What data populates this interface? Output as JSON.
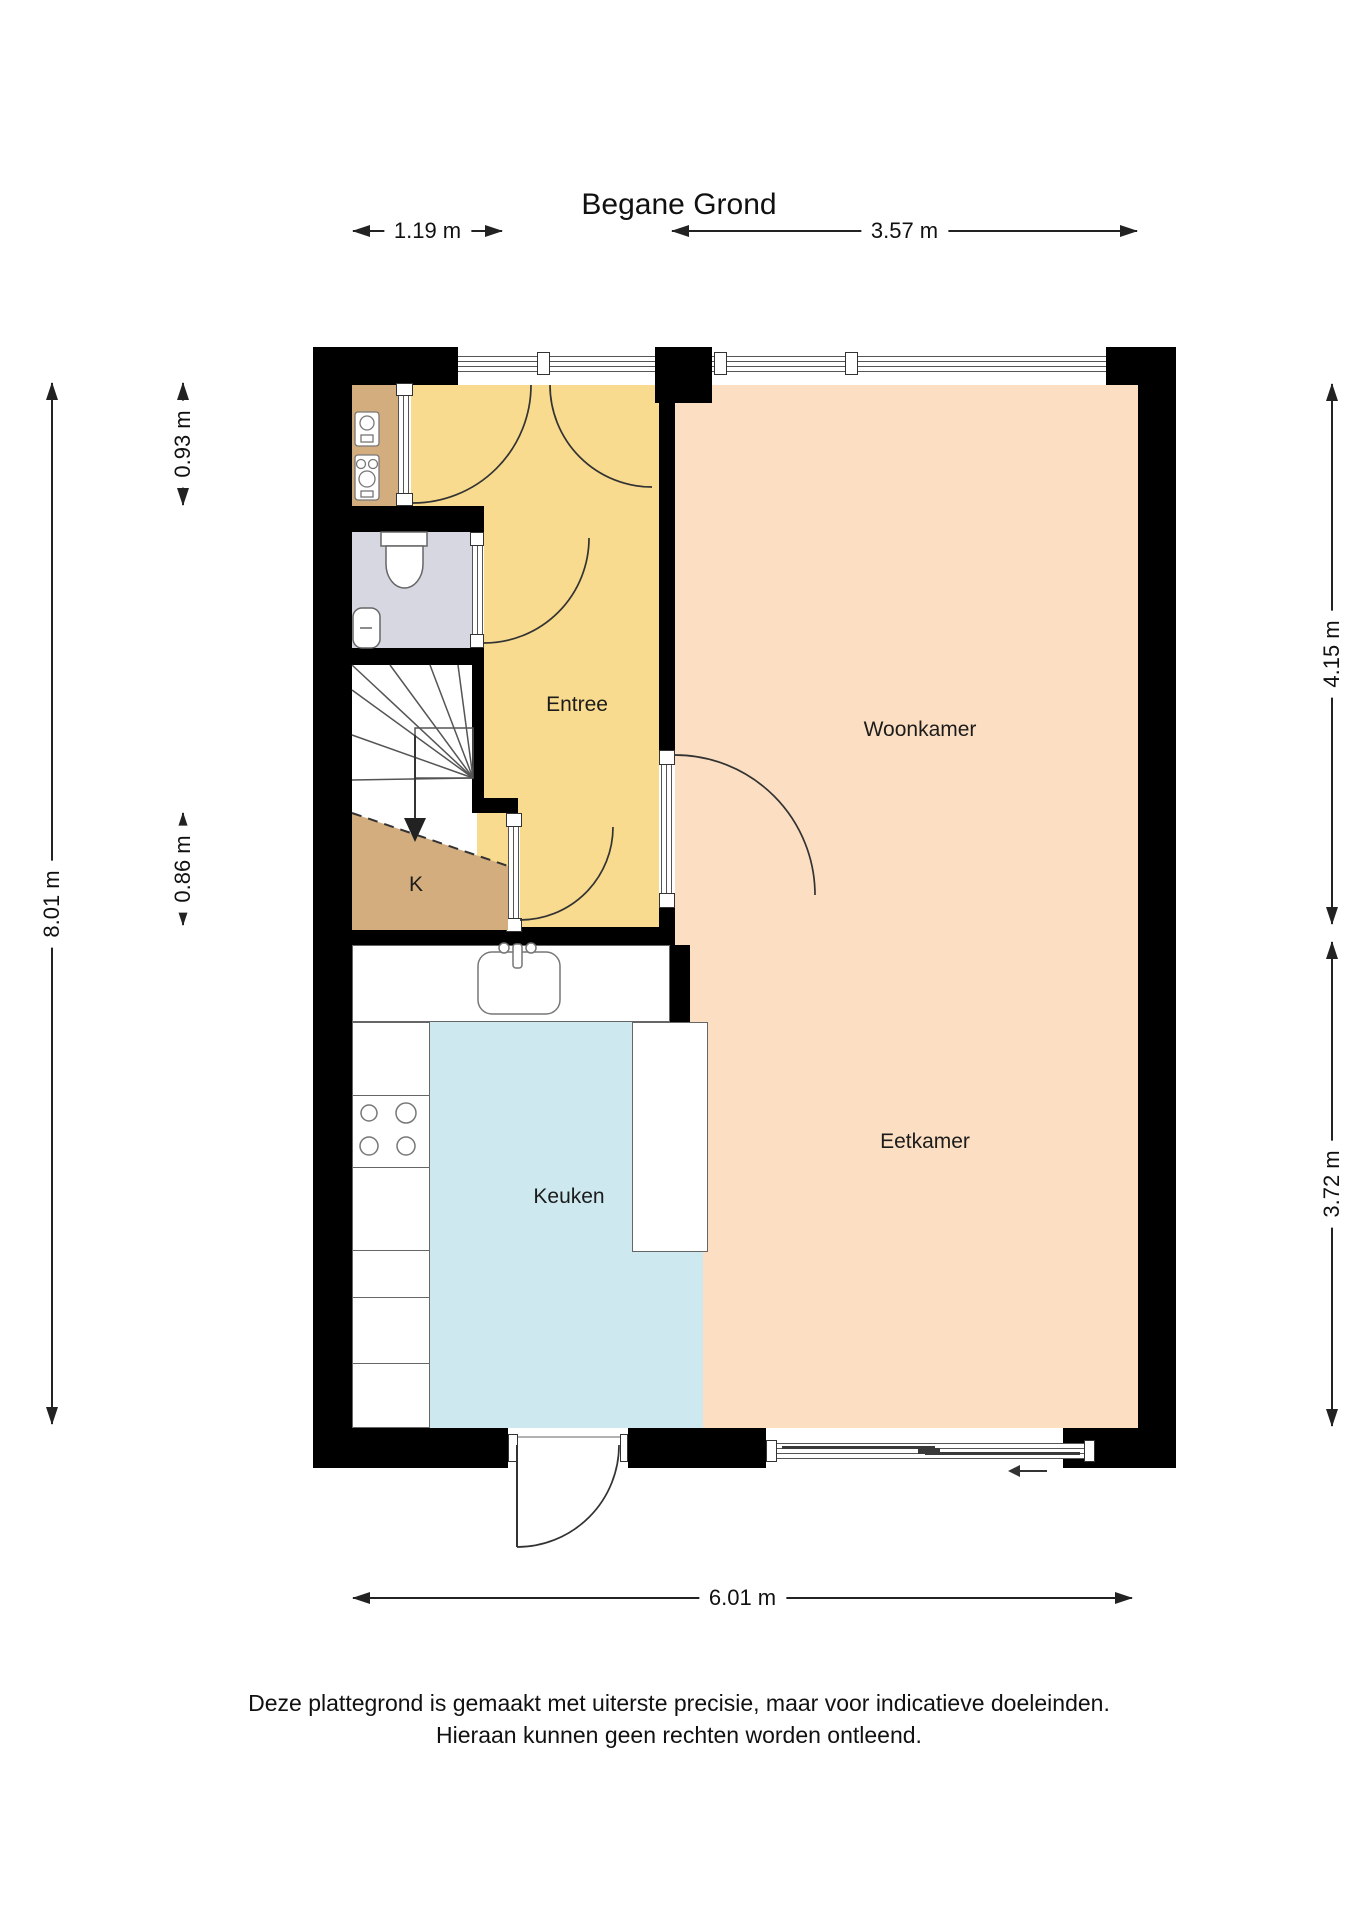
{
  "title": "Begane Grond",
  "rooms": {
    "entree": {
      "label": "Entree"
    },
    "woonkamer": {
      "label": "Woonkamer"
    },
    "eetkamer": {
      "label": "Eetkamer"
    },
    "keuken": {
      "label": "Keuken"
    },
    "kast": {
      "label": "K"
    }
  },
  "dimensions": {
    "d119": "1.19 m",
    "d357": "3.57 m",
    "d801": "8.01 m",
    "d093": "0.93 m",
    "d086": "0.86 m",
    "d415": "4.15 m",
    "d372": "3.72 m",
    "d601": "6.01 m"
  },
  "disclaimer": {
    "line1": "Deze plattegrond is gemaakt met uiterste precisie, maar voor indicatieve doeleinden.",
    "line2": "Hieraan kunnen geen rechten worden ontleend."
  },
  "colors": {
    "wall": "#000000",
    "entree_floor": "#f8db8e",
    "living_floor": "#fcdfc2",
    "kitchen_floor": "#cde9ef",
    "closet_floor": "#d4ad7e",
    "toilet_floor": "#d7d7e2",
    "linework": "#333333"
  },
  "icons": {
    "toilet": "toilet-icon",
    "hand_sink": "hand-sink-icon",
    "kitchen_sink": "kitchen-sink-icon",
    "stove": "stove-burners-icon",
    "meters": "utility-meter-icon",
    "stairs": "stairs-icon",
    "stair_arrow": "stair-direction-arrow-icon",
    "slide_arrow": "slide-direction-arrow-icon",
    "door_arc": "door-swing-arc-icon"
  }
}
